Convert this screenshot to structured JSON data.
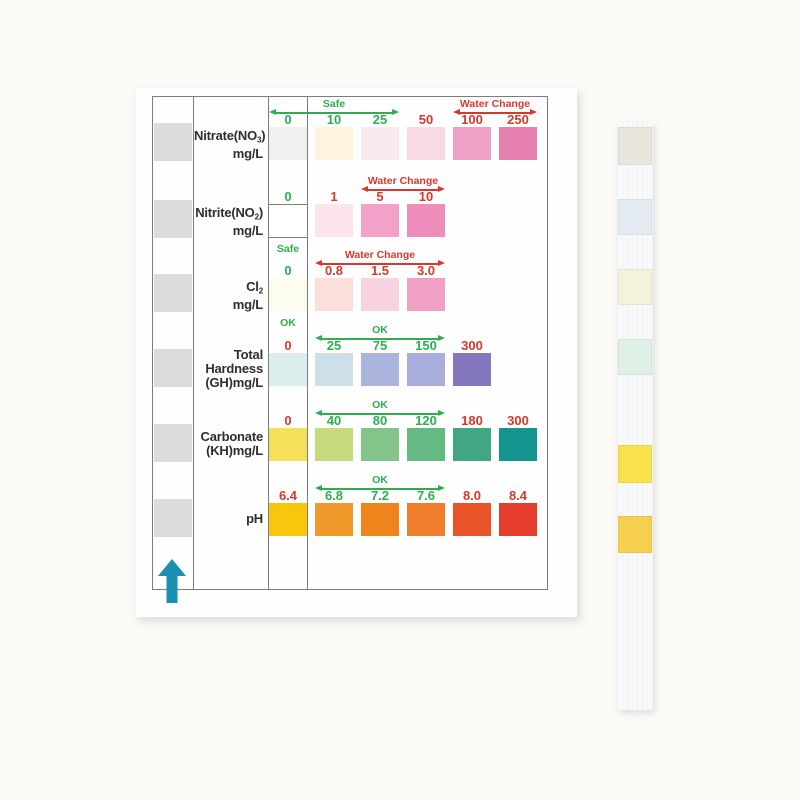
{
  "colors": {
    "page_bg": "#fbfaf6",
    "card_bg": "#fefefe",
    "table_border": "#7c7c7c",
    "safe_green": "#2fae4f",
    "warn_red": "#d6392c",
    "channel_pad_gray": "#dcdcda",
    "arrow_teal": "#1a90b2",
    "strip_bg": "#f7f9fa"
  },
  "rows": [
    {
      "id": "nitrate",
      "label_lines": [
        [
          {
            "t": "Nitrate(NO"
          },
          {
            "t": "3",
            "sub": true
          },
          {
            "t": ")"
          }
        ],
        [
          {
            "t": "mg/L"
          }
        ]
      ],
      "zero": {
        "value": "0",
        "status": "safe",
        "swatch": "#f0f0ee"
      },
      "annotations": [
        {
          "text": "Safe",
          "status": "safe",
          "from": -1,
          "to": 1
        },
        {
          "text": "Water Change",
          "status": "warn",
          "from": 3,
          "to": 4
        }
      ],
      "swatches": [
        {
          "value": "10",
          "status": "safe",
          "color": "#fdf3e1"
        },
        {
          "value": "25",
          "status": "safe",
          "color": "#fae9ee"
        },
        {
          "value": "50",
          "status": "warn",
          "color": "#f8d9e4"
        },
        {
          "value": "100",
          "status": "warn",
          "color": "#efa0c5"
        },
        {
          "value": "250",
          "status": "warn",
          "color": "#e680af"
        }
      ]
    },
    {
      "id": "nitrite",
      "label_lines": [
        [
          {
            "t": "Nitrite(NO"
          },
          {
            "t": "2",
            "sub": true
          },
          {
            "t": ")"
          }
        ],
        [
          {
            "t": "mg/L"
          }
        ]
      ],
      "zero": {
        "value": "0",
        "status": "safe",
        "swatch": "#ffffff",
        "boxed": true,
        "below": "Safe",
        "below_status": "safe"
      },
      "annotations": [
        {
          "text": "Water Change",
          "status": "warn",
          "from": 1,
          "to": 2
        }
      ],
      "swatches": [
        {
          "value": "1",
          "status": "warn",
          "color": "#fce4ed"
        },
        {
          "value": "5",
          "status": "warn",
          "color": "#f2a2c8"
        },
        {
          "value": "10",
          "status": "warn",
          "color": "#ee8dbc"
        }
      ]
    },
    {
      "id": "chlorine",
      "label_lines": [
        [
          {
            "t": "Cl"
          },
          {
            "t": "2",
            "sub": true
          }
        ],
        [
          {
            "t": "mg/L"
          }
        ]
      ],
      "zero": {
        "value": "0",
        "status": "safe",
        "swatch": "#fdfdee",
        "below": "OK",
        "below_status": "safe"
      },
      "annotations": [
        {
          "text": "Water Change",
          "status": "warn",
          "from": 0,
          "to": 2
        }
      ],
      "swatches": [
        {
          "value": "0.8",
          "status": "warn",
          "color": "#fbdfda"
        },
        {
          "value": "1.5",
          "status": "warn",
          "color": "#f9d2df"
        },
        {
          "value": "3.0",
          "status": "warn",
          "color": "#efa0c4"
        }
      ]
    },
    {
      "id": "total-hardness",
      "label_lines": [
        [
          {
            "t": "Total"
          }
        ],
        [
          {
            "t": "Hardness"
          }
        ],
        [
          {
            "t": "(GH)mg/L"
          }
        ]
      ],
      "zero": {
        "value": "0",
        "status": "warn",
        "swatch": "#dcedee"
      },
      "annotations": [
        {
          "text": "OK",
          "status": "safe",
          "from": 0,
          "to": 2
        }
      ],
      "swatches": [
        {
          "value": "25",
          "status": "safe",
          "color": "#cfdfe9"
        },
        {
          "value": "75",
          "status": "safe",
          "color": "#aab3dc"
        },
        {
          "value": "150",
          "status": "safe",
          "color": "#a9addb"
        },
        {
          "value": "300",
          "status": "warn",
          "color": "#8476bf"
        }
      ]
    },
    {
      "id": "carbonate",
      "label_lines": [
        [
          {
            "t": "Carbonate"
          }
        ],
        [
          {
            "t": "(KH)mg/L"
          }
        ]
      ],
      "zero": {
        "value": "0",
        "status": "warn",
        "swatch": "#f5e159"
      },
      "annotations": [
        {
          "text": "OK",
          "status": "safe",
          "from": 0,
          "to": 2
        }
      ],
      "swatches": [
        {
          "value": "40",
          "status": "safe",
          "color": "#c6da7d"
        },
        {
          "value": "80",
          "status": "safe",
          "color": "#82c489"
        },
        {
          "value": "120",
          "status": "safe",
          "color": "#64ba82"
        },
        {
          "value": "180",
          "status": "warn",
          "color": "#41a783"
        },
        {
          "value": "300",
          "status": "warn",
          "color": "#13948d"
        }
      ]
    },
    {
      "id": "ph",
      "label_lines": [
        [
          {
            "t": "pH"
          }
        ]
      ],
      "zero": {
        "value": "6.4",
        "status": "warn",
        "swatch": "#f9c60e"
      },
      "annotations": [
        {
          "text": "OK",
          "status": "safe",
          "from": 0,
          "to": 2
        }
      ],
      "swatches": [
        {
          "value": "6.8",
          "status": "safe",
          "color": "#f1992b"
        },
        {
          "value": "7.2",
          "status": "safe",
          "color": "#ee841b"
        },
        {
          "value": "7.6",
          "status": "safe",
          "color": "#ee7e2b"
        },
        {
          "value": "8.0",
          "status": "warn",
          "color": "#e85327"
        },
        {
          "value": "8.4",
          "status": "warn",
          "color": "#e53d2d"
        }
      ]
    }
  ],
  "strip": {
    "pads": [
      {
        "id": "nitrate",
        "color": "#e8e6dd",
        "top": 127,
        "height": 38
      },
      {
        "id": "nitrite",
        "color": "#e4ebf2",
        "top": 199,
        "height": 36
      },
      {
        "id": "chlorine",
        "color": "#f4f2d9",
        "top": 269,
        "height": 36
      },
      {
        "id": "total-hardness",
        "color": "#dff0e6",
        "top": 339,
        "height": 36
      },
      {
        "id": "carbonate",
        "color": "#f8e14b",
        "top": 445,
        "height": 38
      },
      {
        "id": "ph",
        "color": "#f5cf4d",
        "top": 516,
        "height": 37
      }
    ]
  }
}
